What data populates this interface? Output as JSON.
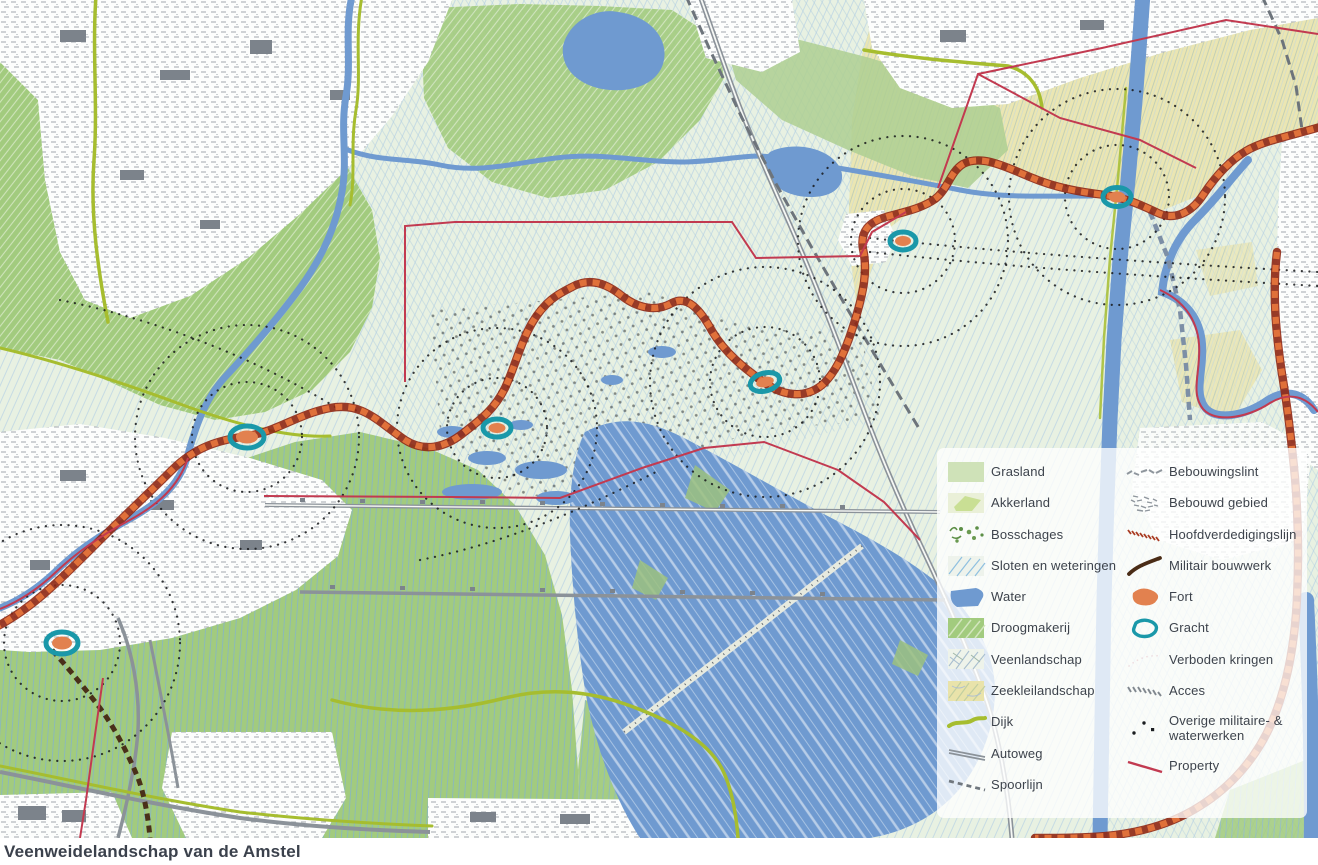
{
  "caption": "Veenweidelandschap van de Amstel",
  "legend": {
    "left": [
      {
        "label": "Grasland",
        "symbol": "grasland-swatch"
      },
      {
        "label": "Akkerland",
        "symbol": "akkerland-swatch"
      },
      {
        "label": "Bosschages",
        "symbol": "bosschages-swatch"
      },
      {
        "label": "Sloten en weteringen",
        "symbol": "sloten-swatch"
      },
      {
        "label": "Water",
        "symbol": "water-swatch"
      },
      {
        "label": "Droogmakerij",
        "symbol": "droogmakerij-swatch"
      },
      {
        "label": "Veenlandschap",
        "symbol": "veenlandschap-swatch"
      },
      {
        "label": "Zeekleilandschap",
        "symbol": "zeekleilandschap-swatch"
      },
      {
        "label": "Dijk",
        "symbol": "dijk-line"
      },
      {
        "label": "Autoweg",
        "symbol": "autoweg-line"
      },
      {
        "label": "Spoorlijn",
        "symbol": "spoorlijn-line"
      }
    ],
    "right": [
      {
        "label": "Bebouwingslint",
        "symbol": "bebouwingslint-squiggle"
      },
      {
        "label": "Bebouwd gebied",
        "symbol": "bebouwd-gebied-texture"
      },
      {
        "label": "Hoofdverdedigingslijn",
        "symbol": "hoofdverdedigingslijn-dashes"
      },
      {
        "label": "Militair bouwwerk",
        "symbol": "militair-bouwwerk-stroke"
      },
      {
        "label": "Fort",
        "symbol": "fort-blob"
      },
      {
        "label": "Gracht",
        "symbol": "gracht-ring"
      },
      {
        "label": "Verboden kringen",
        "symbol": "verboden-kringen-blank"
      },
      {
        "label": "Acces",
        "symbol": "acces-dashes"
      },
      {
        "label": "Overige militaire- & waterwerken",
        "symbol": "overige-dots"
      },
      {
        "label": "Property",
        "symbol": "property-line"
      }
    ]
  },
  "colors": {
    "veen": "#e8f1e2",
    "droogmakerij": "#a2cb7e",
    "zeeklei": "#ebe5af",
    "water": "#6f9ad0",
    "dijk": "#a6bd2f",
    "defense": "#e0713a",
    "fort": "#e2814f",
    "gracht": "#1a98a9",
    "property": "#c23a50",
    "urban": "#9aa1a8"
  }
}
